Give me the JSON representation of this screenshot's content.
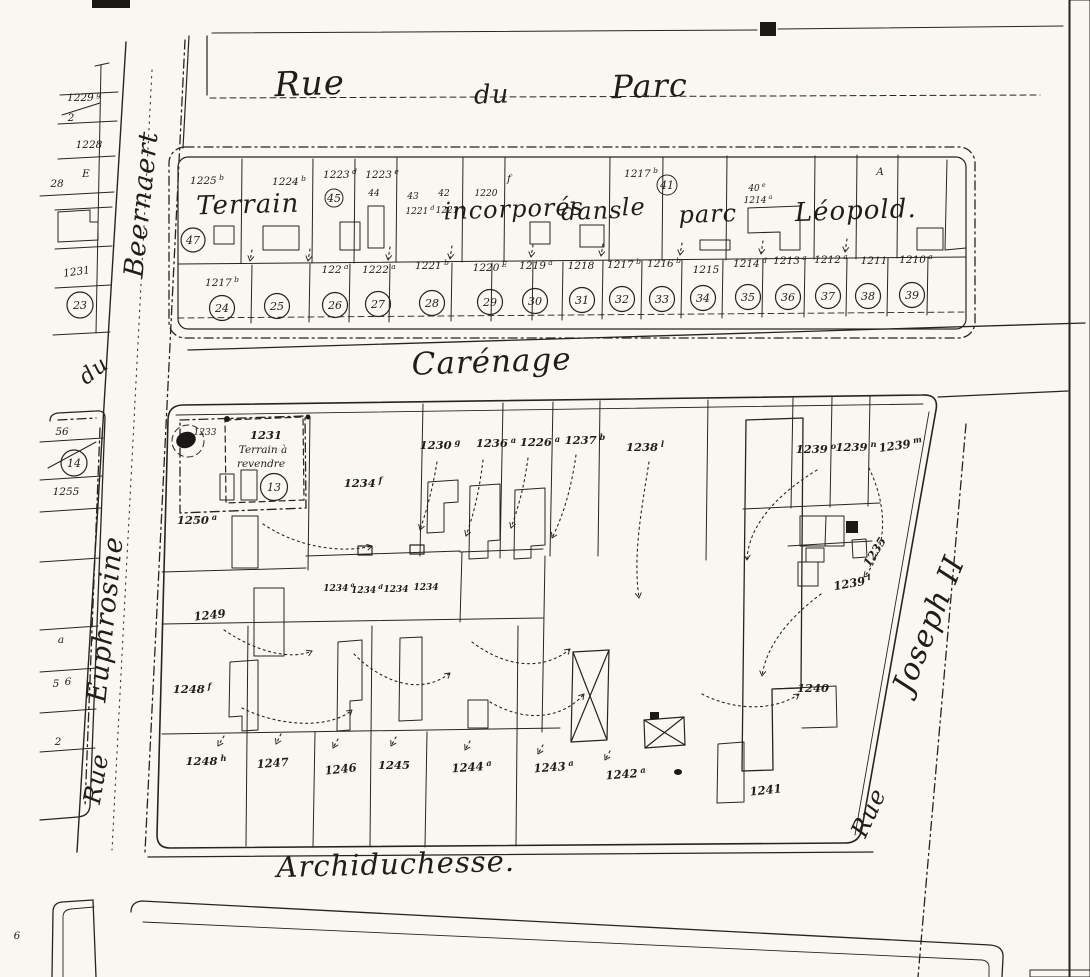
{
  "streets": {
    "rue_du_parc_1": "Rue",
    "rue_du_parc_2": "du",
    "rue_du_parc_3": "Parc",
    "carenage": "Carénage",
    "archiduchesse": "Archiduchesse.",
    "beernaert": "Beernaert",
    "du_fragment": "du",
    "euphrosine": "Euphrosine",
    "rue_west": "Rue",
    "rue_east": "Rue",
    "joseph_ii": "Joseph II"
  },
  "upper_block": {
    "overlay": [
      "Terrain",
      "incorporés",
      "dans",
      "le",
      "parc",
      "Léopold."
    ],
    "top_labels": [
      "1225^b",
      "1224^b",
      "1223^d",
      "45",
      "44",
      "1223^e",
      "43",
      "42",
      "1221^d",
      "1221^e",
      "1220",
      "f",
      "1217^b",
      "41",
      "40^e",
      "1214^a",
      "A",
      "47"
    ],
    "bottom_plots": [
      "1217^b",
      "122^a",
      "1222^a",
      "1221^b",
      "1220^E",
      "1219^a",
      "1218",
      "1217^b",
      "1216^b",
      "1215",
      "1214^d",
      "1213^a",
      "1212^a",
      "1211",
      "1210^a"
    ],
    "circled": [
      "24",
      "25",
      "26",
      "27",
      "28",
      "29",
      "30",
      "31",
      "32",
      "33",
      "34",
      "35",
      "36",
      "37",
      "38",
      "39"
    ]
  },
  "west_parcels": {
    "labels": [
      "1229^g",
      "2",
      "1228",
      "28",
      "E",
      "1231",
      "56",
      "1255",
      "a",
      "5",
      "6",
      "2",
      "6"
    ],
    "circled": [
      "23",
      "14"
    ]
  },
  "lower_block": {
    "sale_area": {
      "small_plot": "1233",
      "plot": "1231",
      "line1": "Terrain à",
      "line2": "revendre",
      "circled": "13"
    },
    "top_plots": [
      "1230^g",
      "1236^a",
      "1226^a",
      "1237^b",
      "1238^l"
    ],
    "right_plots": [
      "1239^o",
      "1239^n",
      "1239^m",
      "1235",
      "1239^l",
      "1240"
    ],
    "mid_plots": [
      "1250^a",
      "1234^f",
      "1234^a",
      "1234^d",
      "1234",
      "1234",
      "1249",
      "1248^f"
    ],
    "bottom_plots": [
      "1248^h",
      "1247",
      "1246",
      "1245",
      "1244^a",
      "1243^a",
      "1242^a",
      "1241"
    ]
  }
}
